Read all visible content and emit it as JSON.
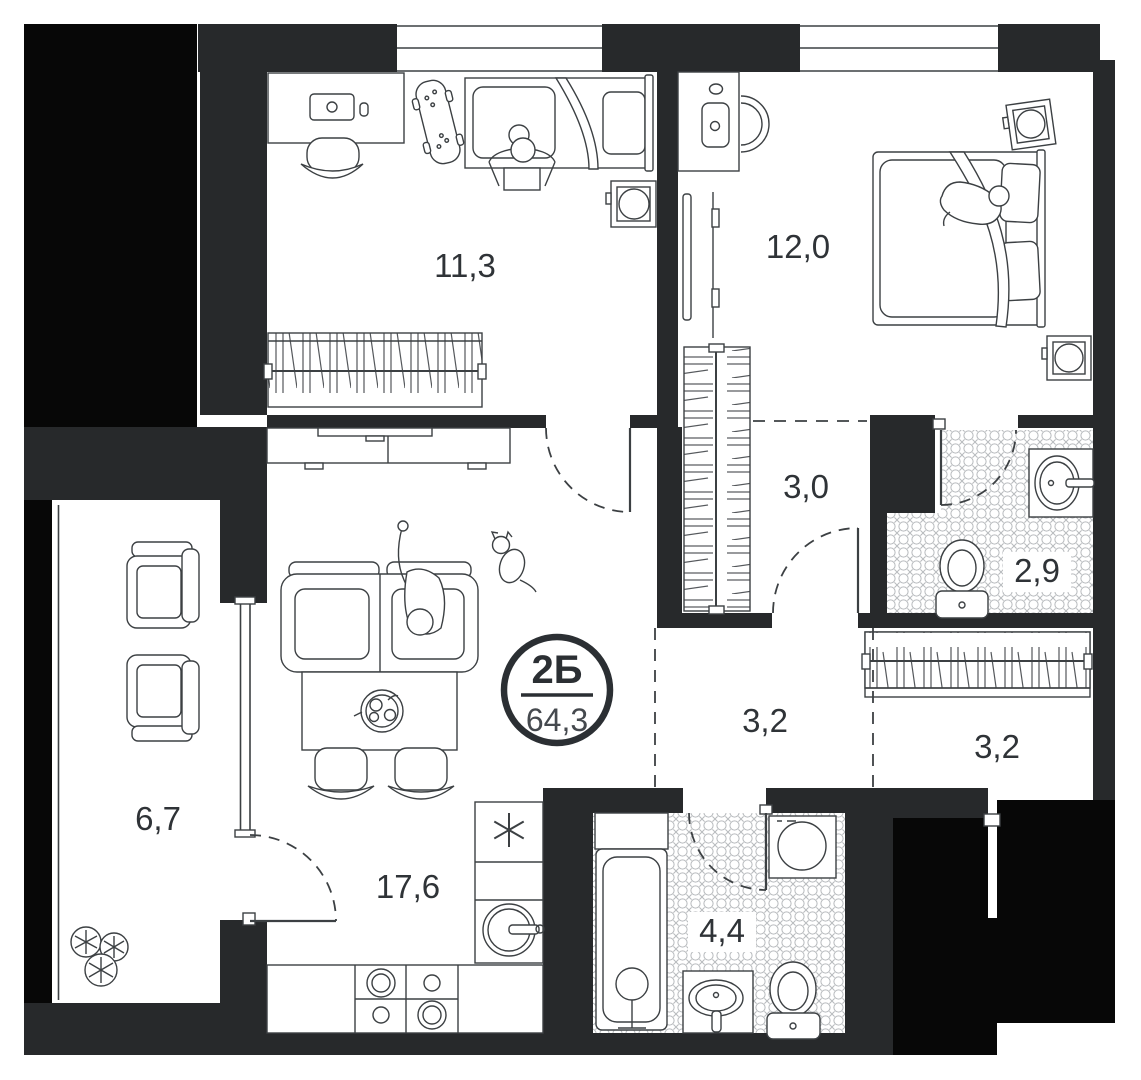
{
  "plan": {
    "badge": {
      "unit_type": "2Б",
      "total_area": "64,3"
    },
    "rooms": [
      {
        "name": "bedroom-secondary",
        "area": "11,3"
      },
      {
        "name": "bedroom-master",
        "area": "12,0"
      },
      {
        "name": "walkthrough-wardrobe",
        "area": "3,0"
      },
      {
        "name": "bathroom-ensuite",
        "area": "2,9"
      },
      {
        "name": "hallway",
        "area": "3,2"
      },
      {
        "name": "entry-wardrobe-hall",
        "area": "3,2"
      },
      {
        "name": "balcony",
        "area": "6,7"
      },
      {
        "name": "kitchen-living-room",
        "area": "17,6"
      },
      {
        "name": "bathroom-main",
        "area": "4,4"
      }
    ],
    "colors": {
      "wall": "#27292b",
      "shaft": "#070707",
      "line": "#3c4043",
      "label": "#2f3337",
      "tile": "#b7babd",
      "hanger": "#55585c",
      "background": "#ffffff"
    },
    "furniture_icons": [
      "desk-icon",
      "office-chair-icon",
      "skateboard-icon",
      "bed-icon",
      "person-icon",
      "speaker-icon",
      "wardrobe-icon",
      "tv-console-icon",
      "tv-icon",
      "mirror-icon",
      "sofa-icon",
      "cat-icon",
      "dining-table-icon",
      "fruit-bowl-icon",
      "chair-icon",
      "armchair-icon",
      "plant-icon",
      "kitchen-counter-icon",
      "cooktop-icon",
      "kitchen-sink-icon",
      "vent-star-icon",
      "bathtub-icon",
      "washing-machine-icon",
      "sink-icon",
      "toilet-icon",
      "pillow-icon",
      "door-swing-icon",
      "window-icon"
    ]
  }
}
